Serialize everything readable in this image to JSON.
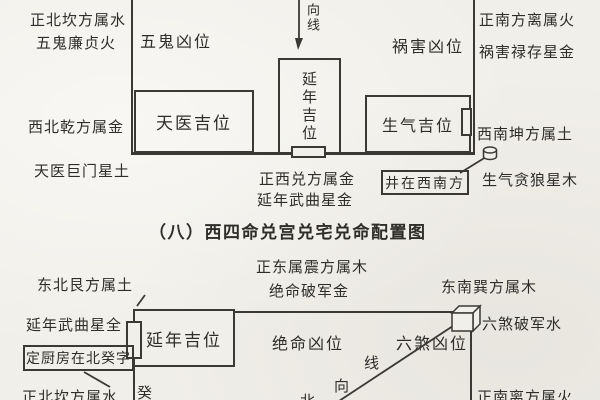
{
  "colors": {
    "paper": "#f1efe9",
    "ink": "#2f2d2a",
    "line": "#3b3934"
  },
  "title": "（八）西四命兑宫兑宅兑命配置图",
  "top_house": {
    "labels": {
      "north": "正北坎方属水",
      "north_star": "五鬼廉贞火",
      "northwest": "西北乾方属金",
      "northwest_star": "天医巨门星土",
      "south": "正南方离属火",
      "south_star": "祸害禄存星金",
      "southwest": "西南坤方属土",
      "southwest_star": "生气贪狼星木",
      "west": "正西兑方属金",
      "west_star": "延年武曲星金"
    },
    "zones": {
      "wugui": "五鬼凶位",
      "huohai": "祸害凶位",
      "tianyi": "天医吉位",
      "yannian": "延年吉位",
      "shengqi": "生气吉位"
    },
    "orientation_line": "向线",
    "well_note": "井在西南方"
  },
  "bottom_house": {
    "labels": {
      "east": "正东属震方属木",
      "east_star": "绝命破军金",
      "northeast": "东北艮方属土",
      "southeast": "东南巽方属木",
      "yannian_star": "延年武曲星全",
      "kitchen_note": "定厨房在北癸字",
      "north": "正北坎方属水",
      "liusha_star": "六煞破军水",
      "south": "正南离方属火"
    },
    "zones": {
      "yannian": "延年吉位",
      "jueming": "绝命凶位",
      "liusha": "六煞凶位"
    },
    "gui_char": "癸",
    "xiang_char": "向",
    "xian_char": "线",
    "bei_char": "北"
  },
  "icons": {
    "well": "well-cylinder-icon",
    "cube": "cube-box-icon",
    "arrow": "down-arrow-icon"
  }
}
